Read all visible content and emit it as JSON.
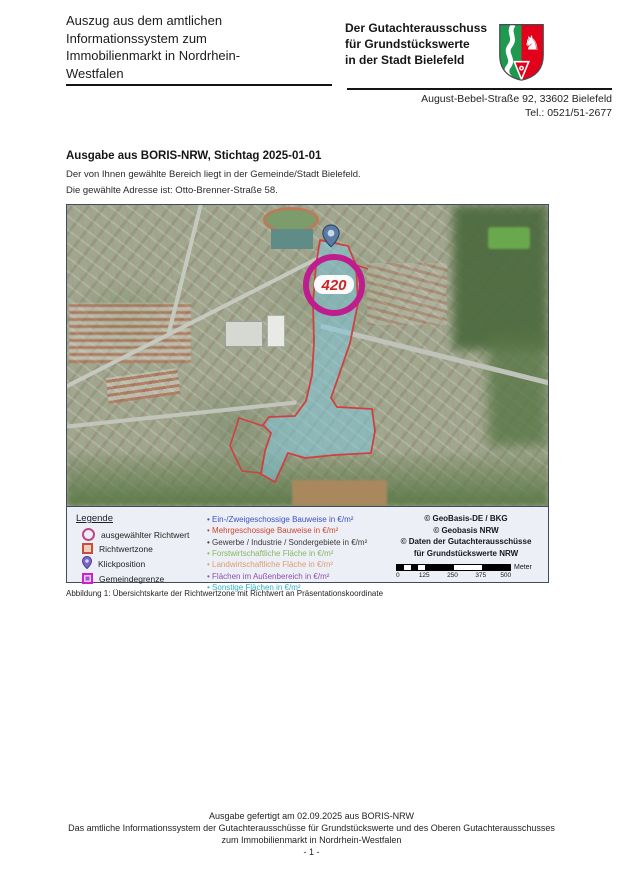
{
  "header": {
    "title_lines": [
      "Auszug aus dem amtlichen",
      "Informationssystem zum",
      "Immobilienmarkt in Nordrhein-",
      "Westfalen"
    ],
    "org_lines": [
      "Der Gutachterausschuss",
      "für Grundstückswerte",
      "in der Stadt Bielefeld"
    ],
    "address": "August-Bebel-Straße 92, 33602 Bielefeld",
    "phone": "Tel.: 0521/51-2677"
  },
  "intro": {
    "heading": "Ausgabe aus BORIS-NRW, Stichtag 2025-01-01",
    "line1": "Der von Ihnen gewählte Bereich liegt in der Gemeinde/Stadt Bielefeld.",
    "line2": "Die gewählte Adresse ist: Otto-Brenner-Straße 58."
  },
  "map": {
    "richtwert_value": "420",
    "legend": {
      "title": "Legende",
      "symbols": [
        {
          "label": "ausgewählter Richtwert"
        },
        {
          "label": "Richtwertzone"
        },
        {
          "label": "Klickposition"
        },
        {
          "label": "Gemeindegrenze"
        }
      ],
      "categories": [
        {
          "label": "Ein-/Zweigeschossige Bauweise in €/m²",
          "color": "#3b52c0"
        },
        {
          "label": "Mehrgeschossige Bauweise in €/m²",
          "color": "#cd4631"
        },
        {
          "label": "Gewerbe / Industrie / Sondergebiete in €/m²",
          "color": "#3a3a3a"
        },
        {
          "label": "Forstwirtschaftliche Fläche in €/m²",
          "color": "#85b861"
        },
        {
          "label": "Landwirtschaftliche Fläche in €/m²",
          "color": "#dd9b72"
        },
        {
          "label": "Flächen im Außenbereich in €/m²",
          "color": "#8f4fae"
        },
        {
          "label": "Sonstige Flächen in €/m²",
          "color": "#2fb0c8"
        }
      ]
    },
    "copyright_lines": [
      "© GeoBasis-DE / BKG",
      "© Geobasis NRW",
      "© Daten der Gutachterausschüsse",
      "für Grundstückswerte NRW"
    ],
    "scale": {
      "ticks": [
        "0",
        "125",
        "250",
        "375",
        "500"
      ],
      "unit": "Meter"
    }
  },
  "caption": "Abbildung 1: Übersichtskarte der Richtwertzone mit Richtwert an Präsentationskoordinate",
  "footer": {
    "line1": "Ausgabe gefertigt am 02.09.2025 aus BORIS-NRW",
    "line2": "Das amtliche Informationssystem der Gutachterausschüsse für Grundstückswerte und des Oberen Gutachterausschusses",
    "line3": "zum Immobilienmarkt in Nordrhein-Westfalen",
    "page": "- 1 -"
  },
  "theme": {
    "accent_magenta": "#bf1d8d",
    "value_red": "#cc2222",
    "zone_fill": "#7dc8de",
    "zone_border": "#cf4040",
    "pin_blue": "#5a7ba3",
    "legend_bg": "#edeff6"
  }
}
